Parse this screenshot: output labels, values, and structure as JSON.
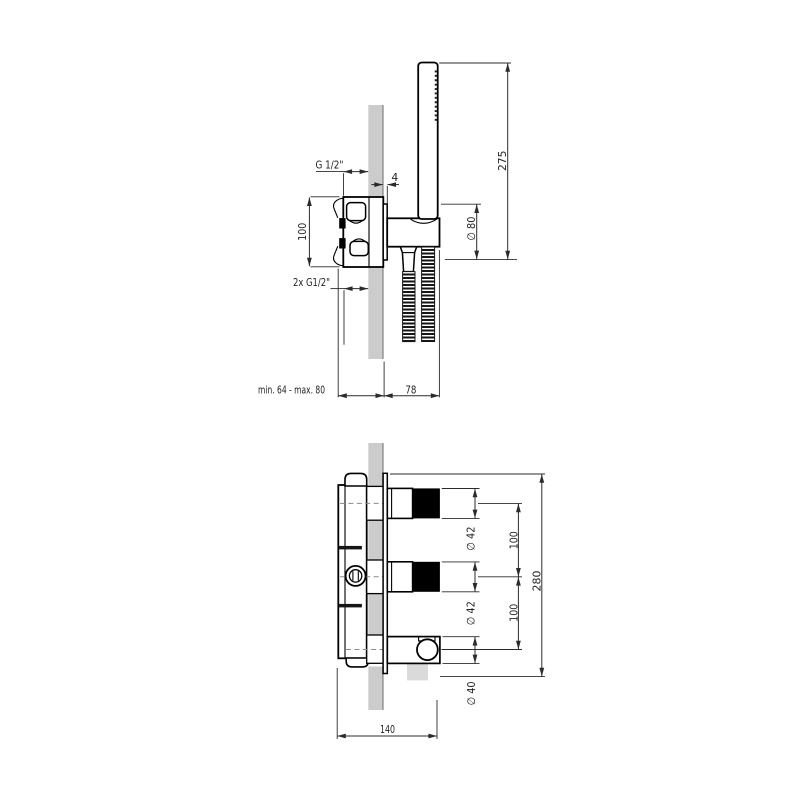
{
  "colors": {
    "wall_fill": "#cccccc",
    "wall_edge": "#969696",
    "line": "#000000",
    "dim_line": "#2b2b2b",
    "text": "#222222",
    "knob_fill": "#000000",
    "hose_ghost": "#dadada"
  },
  "top_view": {
    "dimensions": {
      "connection_top": "G 1/2\"",
      "plate_thickness": "4",
      "inlet_spacing": "100",
      "connection_bottom": "2x G1/2\"",
      "recess_depth": "min. 64 - max. 80",
      "wall_offset": "78",
      "handshower_height": "275",
      "holder_plate_diameter": "∅ 80"
    }
  },
  "bottom_view": {
    "dimensions": {
      "upper_knob_diameter": "∅ 42",
      "lower_knob_diameter": "∅ 42",
      "upper_spacing": "100",
      "lower_spacing": "100",
      "overall_height": "280",
      "outlet_diameter": "∅ 40",
      "overall_width": "140"
    }
  }
}
